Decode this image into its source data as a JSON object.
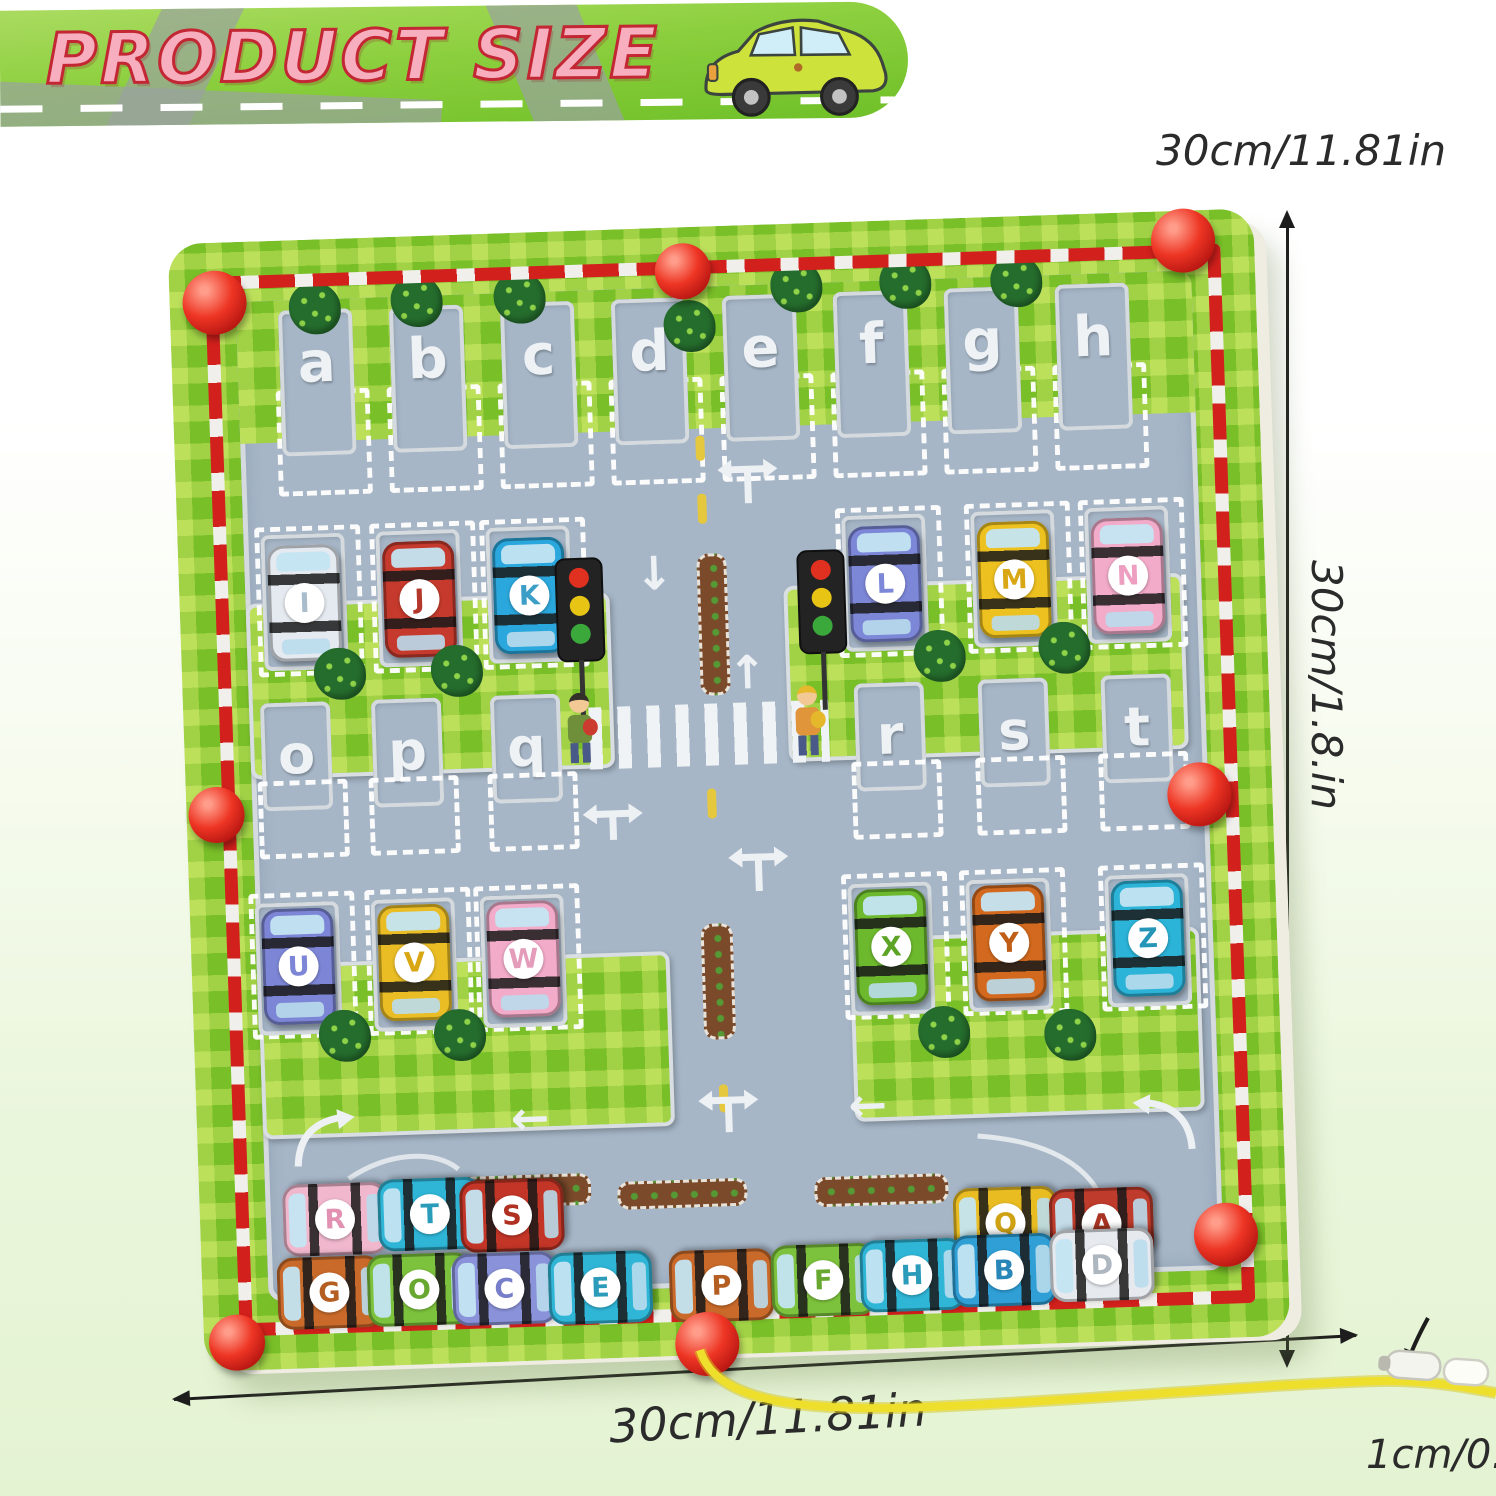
{
  "banner": {
    "title": "PRODUCT SIZE"
  },
  "dimensions": {
    "top": "30cm/11.81in",
    "side": "30cm/1.8.in",
    "bottom": "30cm/11.81in",
    "thickness": "1cm/0.39in"
  },
  "board": {
    "top_slots": [
      "a",
      "b",
      "c",
      "d",
      "e",
      "f",
      "g",
      "h"
    ],
    "left_slots": [
      "o",
      "p",
      "q"
    ],
    "right_slots": [
      "r",
      "s",
      "t"
    ]
  },
  "cars": [
    {
      "letter": "I",
      "body": "#e4eaf0",
      "text": "#a8bccb"
    },
    {
      "letter": "J",
      "body": "#c53a2c",
      "text": "#b4372b"
    },
    {
      "letter": "K",
      "body": "#2aa7dc",
      "text": "#3b9ec7"
    },
    {
      "letter": "L",
      "body": "#7d87d8",
      "text": "#7d87d8"
    },
    {
      "letter": "M",
      "body": "#edc11f",
      "text": "#d8a713"
    },
    {
      "letter": "N",
      "body": "#f2abc9",
      "text": "#ee9ec0"
    },
    {
      "letter": "U",
      "body": "#7d86d6",
      "text": "#7d86d6"
    },
    {
      "letter": "V",
      "body": "#eabd25",
      "text": "#d8a713"
    },
    {
      "letter": "W",
      "body": "#f2abc9",
      "text": "#e49cba"
    },
    {
      "letter": "X",
      "body": "#6db92e",
      "text": "#5ca326"
    },
    {
      "letter": "Y",
      "body": "#d2691e",
      "text": "#c05e18"
    },
    {
      "letter": "Z",
      "body": "#2bb3d8",
      "text": "#2596b8"
    },
    {
      "letter": "R",
      "body": "#f0b7cd",
      "text": "#e391b2"
    },
    {
      "letter": "T",
      "body": "#2fb5d6",
      "text": "#2a9cba"
    },
    {
      "letter": "S",
      "body": "#c23527",
      "text": "#b03022"
    },
    {
      "letter": "Q",
      "body": "#e9bc22",
      "text": "#cfa214"
    },
    {
      "letter": "A",
      "body": "#bf3b2b",
      "text": "#aa3424"
    },
    {
      "letter": "G",
      "body": "#c96a2a",
      "text": "#b55e22"
    },
    {
      "letter": "O",
      "body": "#7cc23c",
      "text": "#69a830"
    },
    {
      "letter": "C",
      "body": "#8a92da",
      "text": "#767ec9"
    },
    {
      "letter": "E",
      "body": "#2fb5d6",
      "text": "#2a9cba"
    },
    {
      "letter": "P",
      "body": "#c96a2a",
      "text": "#b55e22"
    },
    {
      "letter": "F",
      "body": "#7cc23c",
      "text": "#69a830"
    },
    {
      "letter": "H",
      "body": "#2fb5d6",
      "text": "#2a9cba"
    },
    {
      "letter": "B",
      "body": "#2f9fd6",
      "text": "#2887b8"
    },
    {
      "letter": "D",
      "body": "#e6e9ee",
      "text": "#aeb6bf"
    }
  ],
  "colors": {
    "board_green": "#79bf28",
    "road_gray": "#a6b6c7",
    "barrier_red": "#d2201c",
    "ball_red": "#ee3524",
    "string_yellow": "#efdf2d",
    "title_pink": "#f7aebf",
    "title_outline": "#c22733"
  }
}
